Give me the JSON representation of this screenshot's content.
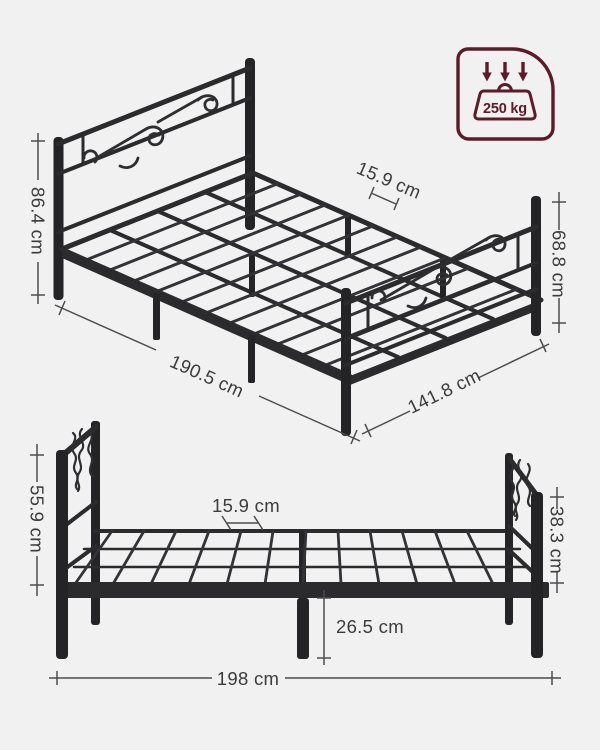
{
  "colors": {
    "background": "#f1f1f1",
    "frame_dark": "#2b2b2e",
    "frame_mid": "#353539",
    "dimension_line": "#4c4c4f",
    "dimension_text": "#3b3b3e",
    "accent_maroon": "#5d1b29"
  },
  "capacity_badge": {
    "value": "250 kg",
    "icons": [
      "arrow-down-icon",
      "arrow-down-icon",
      "arrow-down-icon",
      "weight-icon"
    ]
  },
  "perspective_view": {
    "dimensions": {
      "headboard_height": "86.4 cm",
      "slat_spacing": "15.9 cm",
      "footboard_height": "68.8 cm",
      "frame_length": "190.5 cm",
      "frame_width": "141.8 cm"
    }
  },
  "side_view": {
    "dimensions": {
      "headboard_height": "55.9 cm",
      "slat_spacing": "15.9 cm",
      "footboard_height": "38.3 cm",
      "under_bed_clearance": "26.5 cm",
      "frame_length": "198 cm"
    }
  }
}
